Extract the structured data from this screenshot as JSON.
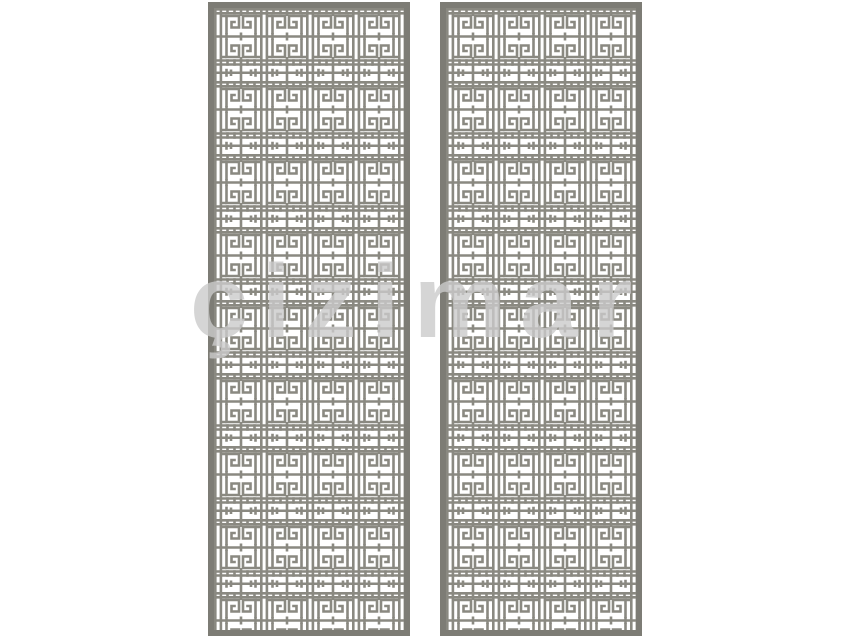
{
  "watermark": {
    "text": "çizimar"
  },
  "colors": {
    "background": "#ffffff",
    "lattice": "#8a8981",
    "panel_border": "#7d7c75",
    "watermark": "#cbcbcb"
  },
  "panels": {
    "count": 2,
    "columns_per_panel": 4,
    "motif": "hook-spiral lattice"
  }
}
